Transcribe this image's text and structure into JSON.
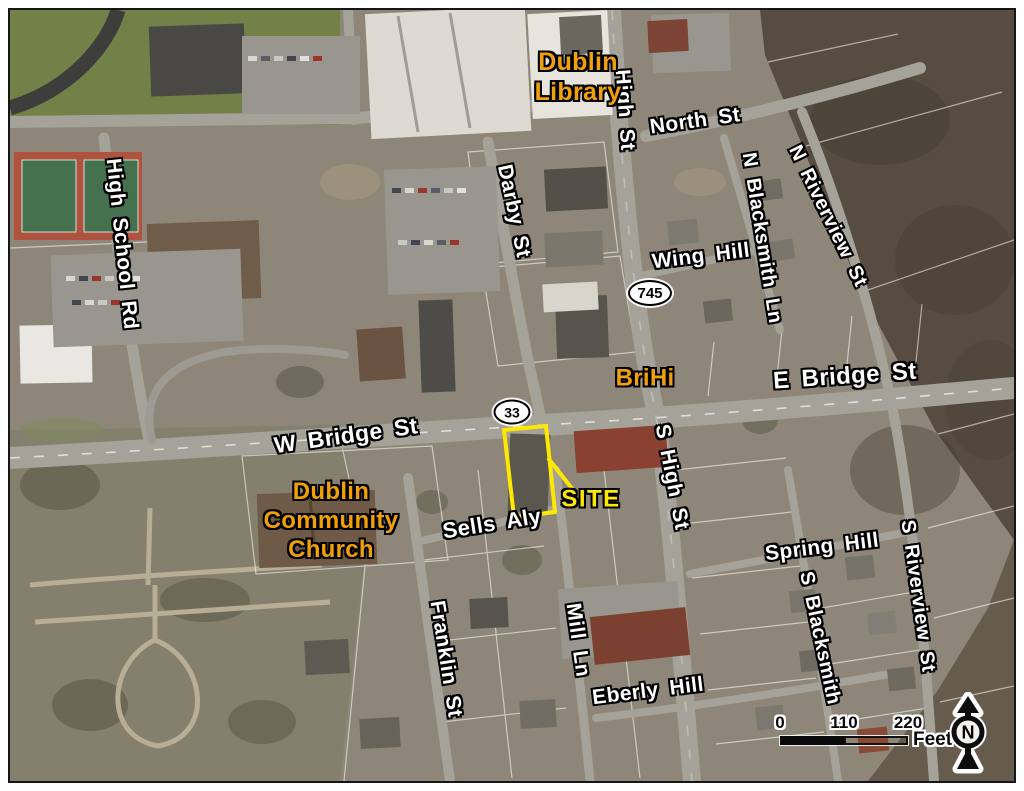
{
  "map": {
    "colors": {
      "street_label": "#ffffff",
      "landmark_label": "#f1a008",
      "site": "#ffe800",
      "halo": "#000000",
      "site_outline": "#ffe800"
    },
    "street_labels": [
      {
        "name": "label-north-st",
        "text": "North St",
        "x": 695,
        "y": 121,
        "rot": -8,
        "fs": 21
      },
      {
        "name": "label-high-st",
        "text": "High St",
        "x": 625,
        "y": 110,
        "rot": 86,
        "fs": 21
      },
      {
        "name": "label-n-riverview-st",
        "text": "N Riverview St",
        "x": 828,
        "y": 216,
        "rot": 64,
        "fs": 20
      },
      {
        "name": "label-n-blacksmith-ln",
        "text": "N Blacksmith Ln",
        "x": 762,
        "y": 238,
        "rot": 81,
        "fs": 20
      },
      {
        "name": "label-wing-hill",
        "text": "Wing Hill",
        "x": 701,
        "y": 256,
        "rot": -7,
        "fs": 21
      },
      {
        "name": "label-darby-st",
        "text": "Darby St",
        "x": 514,
        "y": 211,
        "rot": 78,
        "fs": 21
      },
      {
        "name": "label-high-school-rd",
        "text": "High School Rd",
        "x": 122,
        "y": 244,
        "rot": 84,
        "fs": 21
      },
      {
        "name": "label-e-bridge-st",
        "text": "E Bridge St",
        "x": 845,
        "y": 377,
        "rot": -4,
        "fs": 24
      },
      {
        "name": "label-w-bridge-st",
        "text": "W Bridge St",
        "x": 346,
        "y": 436,
        "rot": -8,
        "fs": 23
      },
      {
        "name": "label-sells-aly",
        "text": "Sells Aly",
        "x": 492,
        "y": 524,
        "rot": -9,
        "fs": 22
      },
      {
        "name": "label-s-high-st",
        "text": "S High St",
        "x": 672,
        "y": 477,
        "rot": 79,
        "fs": 21
      },
      {
        "name": "label-spring-hill",
        "text": "Spring Hill",
        "x": 822,
        "y": 547,
        "rot": -7,
        "fs": 21
      },
      {
        "name": "label-s-blacksmith",
        "text": "S Blacksmith",
        "x": 820,
        "y": 638,
        "rot": 78,
        "fs": 20
      },
      {
        "name": "label-s-riverview-st",
        "text": "S Riverview St",
        "x": 918,
        "y": 596,
        "rot": 82,
        "fs": 20
      },
      {
        "name": "label-franklin-st",
        "text": "Franklin St",
        "x": 446,
        "y": 659,
        "rot": 81,
        "fs": 21
      },
      {
        "name": "label-mill-ln",
        "text": "Mill Ln",
        "x": 578,
        "y": 640,
        "rot": 82,
        "fs": 21
      },
      {
        "name": "label-eberly-hill",
        "text": "Eberly Hill",
        "x": 648,
        "y": 691,
        "rot": -7,
        "fs": 21
      }
    ],
    "landmark_labels": [
      {
        "name": "label-dublin-library",
        "lines": [
          "Dublin",
          "Library"
        ],
        "x": 578,
        "y": 77,
        "rot": 0,
        "fs": 25
      },
      {
        "name": "label-brihi",
        "lines": [
          "BriHi"
        ],
        "x": 645,
        "y": 379,
        "rot": 0,
        "fs": 24
      },
      {
        "name": "label-dublin-community-church",
        "lines": [
          "Dublin",
          "Community",
          "Church"
        ],
        "x": 331,
        "y": 521,
        "rot": 0,
        "fs": 24
      }
    ],
    "site": {
      "name": "site-label",
      "text": "SITE",
      "x": 591,
      "y": 500,
      "rot": 0,
      "fs": 24
    },
    "route_shields": [
      {
        "name": "route-shield-745",
        "text": "745",
        "x": 650,
        "y": 293,
        "w": 40,
        "h": 22,
        "fs": 15
      },
      {
        "name": "route-shield-33",
        "text": "33",
        "x": 512,
        "y": 412,
        "w": 33,
        "h": 21,
        "fs": 14
      }
    ],
    "scale_bar": {
      "ticks": [
        "0",
        "110",
        "220"
      ],
      "unit": "Feet"
    },
    "north_arrow": {
      "label": "N"
    }
  }
}
